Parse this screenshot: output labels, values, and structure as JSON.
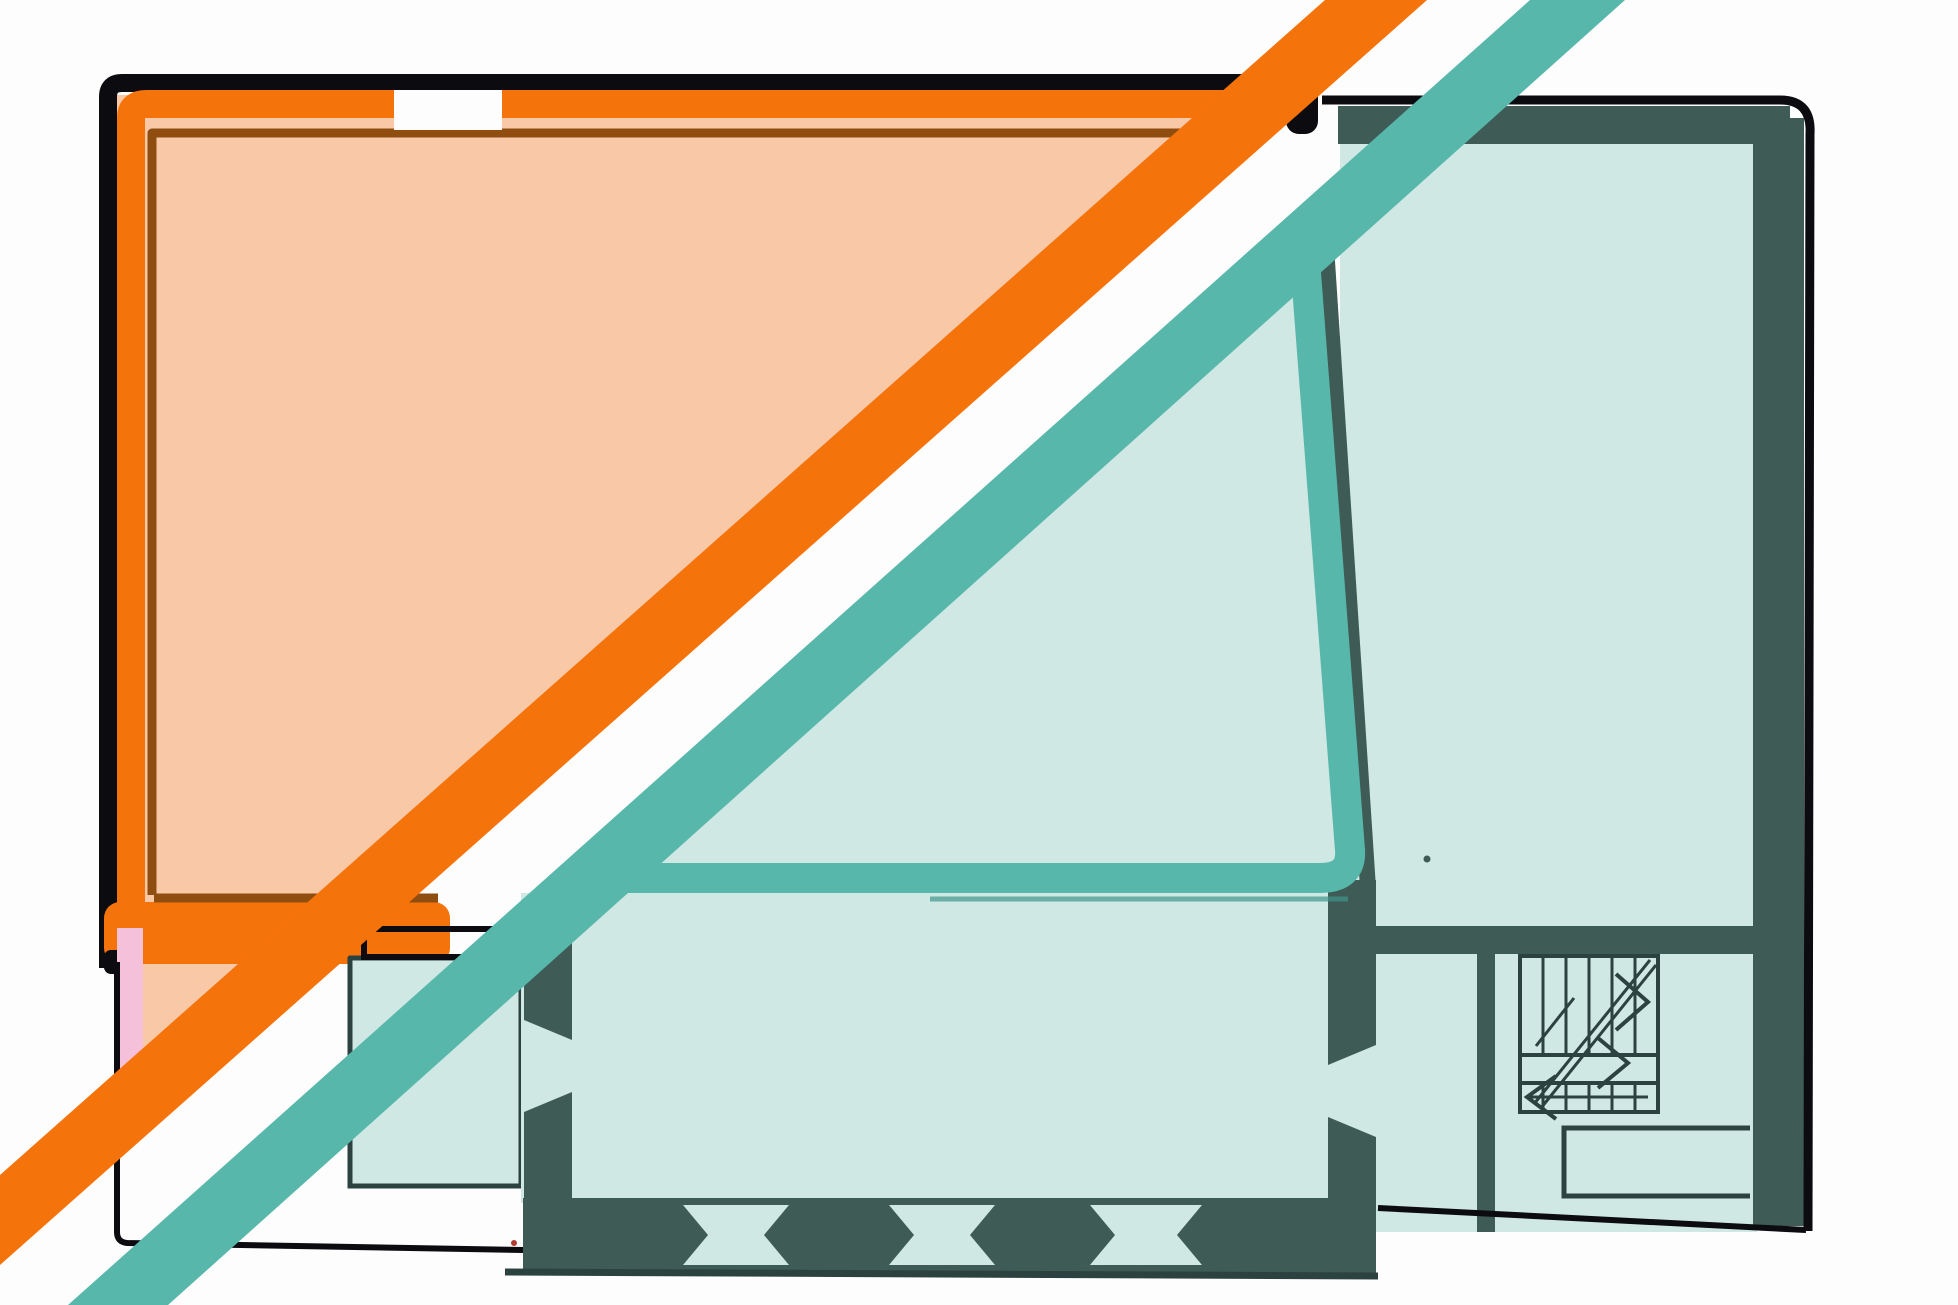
{
  "canvas": {
    "width_px": 1958,
    "height_px": 1305,
    "view_box": "0 0 1958 1305"
  },
  "scene": {
    "kind": "hand-drawn floor plan sketch with colored highlight overlays and two diagonal accent stripes",
    "text_content": ""
  },
  "colors": {
    "background": "#fdfdfd",
    "peach": "#f8c8a7",
    "orange": "#f5730b",
    "orange-dark-line": "#8f4e10",
    "ink-black": "#0b0b10",
    "mint": "#cfe8e3",
    "teal": "#58b7ab",
    "teal-dark-underline": "#3e958a",
    "slate": "#3e5b56",
    "plan-line": "#2c4240",
    "pink": "#f5c0da",
    "speck-red": "#b23a31"
  }
}
